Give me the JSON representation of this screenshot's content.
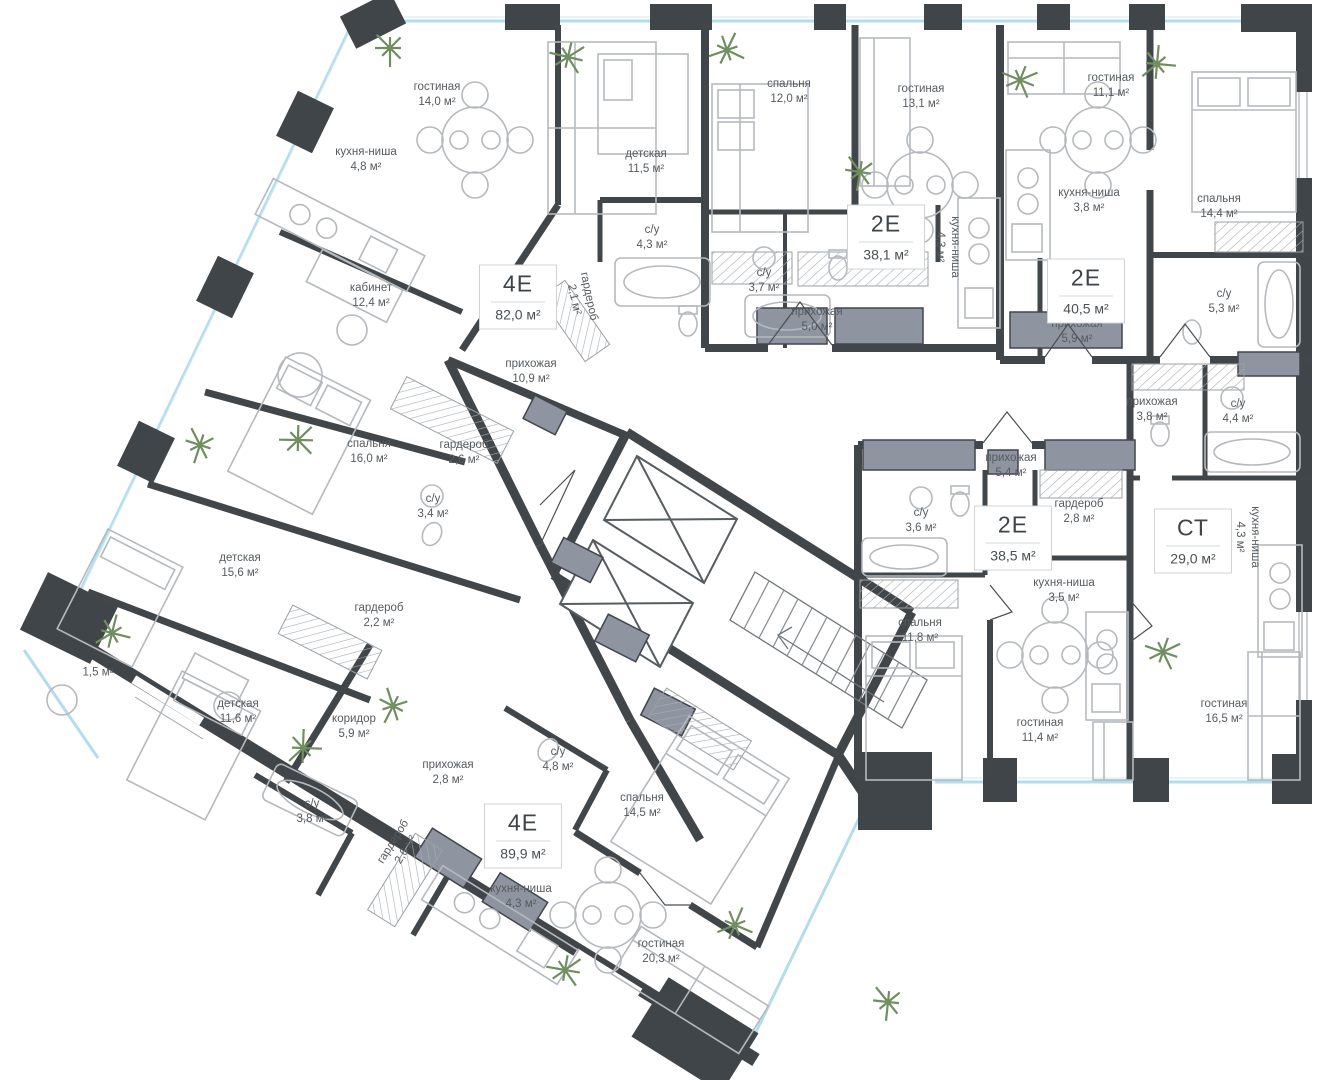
{
  "plan": {
    "title": "floor-plan",
    "unit_suffix": "м²",
    "colors": {
      "wall": "#3f4549",
      "glazing": "#b3dcec",
      "shaft": "#8e95a1",
      "furniture": "#b5b9be",
      "label_text": "#565b5f",
      "plant": "#6f8f5f",
      "badge_border": "#cfd3d6"
    },
    "apartments": [
      {
        "type": "4Е",
        "area": "82,0 м²",
        "x": 518,
        "y": 297
      },
      {
        "type": "2Е",
        "area": "38,1 м²",
        "x": 886,
        "y": 237
      },
      {
        "type": "2Е",
        "area": "40,5 м²",
        "x": 1086,
        "y": 291
      },
      {
        "type": "2Е",
        "area": "38,5 м²",
        "x": 1013,
        "y": 538
      },
      {
        "type": "СТ",
        "area": "29,0 м²",
        "x": 1193,
        "y": 541
      },
      {
        "type": "4Е",
        "area": "89,9 м²",
        "x": 523,
        "y": 836
      }
    ],
    "rooms": [
      {
        "n": "гостиная",
        "a": "14,0 м²",
        "x": 437,
        "y": 95,
        "r": 0
      },
      {
        "n": "кухня-ниша",
        "a": "4,8 м²",
        "x": 366,
        "y": 160,
        "r": 0
      },
      {
        "n": "кабинет",
        "a": "12,4 м²",
        "x": 371,
        "y": 296,
        "r": 0
      },
      {
        "n": "детская",
        "a": "11,5 м²",
        "x": 646,
        "y": 162,
        "r": 0
      },
      {
        "n": "с/у",
        "a": "4,3 м²",
        "x": 652,
        "y": 238,
        "r": 0
      },
      {
        "n": "гардероб",
        "a": "2,1 м²",
        "x": 581,
        "y": 298,
        "r": 78
      },
      {
        "n": "прихожая",
        "a": "10,9 м²",
        "x": 531,
        "y": 372,
        "r": 0
      },
      {
        "n": "спальня",
        "a": "16,0 м²",
        "x": 369,
        "y": 452,
        "r": 0
      },
      {
        "n": "гардероб",
        "a": "2,6 м²",
        "x": 464,
        "y": 453,
        "r": 0
      },
      {
        "n": "с/у",
        "a": "3,4 м²",
        "x": 433,
        "y": 507,
        "r": 0
      },
      {
        "n": "детская",
        "a": "15,6 м²",
        "x": 240,
        "y": 566,
        "r": 0
      },
      {
        "n": "спальня",
        "a": "12,0 м²",
        "x": 789,
        "y": 92,
        "r": 0
      },
      {
        "n": "с/у",
        "a": "3,7 м²",
        "x": 764,
        "y": 281,
        "r": 0
      },
      {
        "n": "прихожая",
        "a": "5,0 м²",
        "x": 817,
        "y": 320,
        "r": 0
      },
      {
        "n": "гостиная",
        "a": "13,1 м²",
        "x": 921,
        "y": 97,
        "r": 0
      },
      {
        "n": "кухня-ниша",
        "a": "4,3 м²",
        "x": 947,
        "y": 247,
        "r": 90
      },
      {
        "n": "гостиная",
        "a": "11,1 м²",
        "x": 1111,
        "y": 86,
        "r": 0
      },
      {
        "n": "кухня-ниша",
        "a": "3,8 м²",
        "x": 1089,
        "y": 201,
        "r": 0
      },
      {
        "n": "прихожая",
        "a": "5,9 м²",
        "x": 1077,
        "y": 332,
        "r": 0
      },
      {
        "n": "спальня",
        "a": "14,4 м²",
        "x": 1219,
        "y": 207,
        "r": 0
      },
      {
        "n": "с/у",
        "a": "5,3 м²",
        "x": 1224,
        "y": 302,
        "r": 0
      },
      {
        "n": "прихожая",
        "a": "3,8 м²",
        "x": 1152,
        "y": 410,
        "r": 0
      },
      {
        "n": "с/у",
        "a": "4,4 м²",
        "x": 1238,
        "y": 412,
        "r": 0
      },
      {
        "n": "кухня-ниша",
        "a": "4,3 м²",
        "x": 1247,
        "y": 537,
        "r": 90
      },
      {
        "n": "гостиная",
        "a": "16,5 м²",
        "x": 1224,
        "y": 712,
        "r": 0
      },
      {
        "n": "прихожая",
        "a": "5,4 м²",
        "x": 1011,
        "y": 466,
        "r": 0
      },
      {
        "n": "с/у",
        "a": "3,6 м²",
        "x": 921,
        "y": 521,
        "r": 0
      },
      {
        "n": "гардероб",
        "a": "2,8 м²",
        "x": 1079,
        "y": 512,
        "r": 0
      },
      {
        "n": "кухня-ниша",
        "a": "3,5 м²",
        "x": 1064,
        "y": 591,
        "r": 0
      },
      {
        "n": "спальня",
        "a": "11,8 м²",
        "x": 920,
        "y": 631,
        "r": 0
      },
      {
        "n": "гостиная",
        "a": "11,4 м²",
        "x": 1040,
        "y": 731,
        "r": 0
      },
      {
        "n": "гардероб",
        "a": "2,2 м²",
        "x": 379,
        "y": 616,
        "r": 0
      },
      {
        "n": "",
        "a": "1,5 м²",
        "x": 98,
        "y": 673,
        "r": 0
      },
      {
        "n": "детская",
        "a": "11,6 м²",
        "x": 238,
        "y": 712,
        "r": 0
      },
      {
        "n": "коридор",
        "a": "5,9 м²",
        "x": 354,
        "y": 727,
        "r": 0
      },
      {
        "n": "прихожая",
        "a": "2,8 м²",
        "x": 448,
        "y": 773,
        "r": 0
      },
      {
        "n": "с/у",
        "a": "3,8 м²",
        "x": 312,
        "y": 812,
        "r": 0
      },
      {
        "n": "гардероб",
        "a": "2,6 м²",
        "x": 400,
        "y": 846,
        "r": -58
      },
      {
        "n": "с/у",
        "a": "4,8 м²",
        "x": 558,
        "y": 760,
        "r": 0
      },
      {
        "n": "спальня",
        "a": "14,5 м²",
        "x": 642,
        "y": 806,
        "r": 0
      },
      {
        "n": "кухня-ниша",
        "a": "4,3 м²",
        "x": 521,
        "y": 897,
        "r": 0
      },
      {
        "n": "гостиная",
        "a": "20,3 м²",
        "x": 661,
        "y": 952,
        "r": 0
      }
    ],
    "plants": [
      [
        390,
        48
      ],
      [
        568,
        57
      ],
      [
        727,
        50
      ],
      [
        860,
        172
      ],
      [
        1020,
        80
      ],
      [
        1157,
        64
      ],
      [
        200,
        445
      ],
      [
        298,
        440
      ],
      [
        112,
        633
      ],
      [
        393,
        706
      ],
      [
        565,
        970
      ],
      [
        735,
        925
      ],
      [
        888,
        1002
      ],
      [
        1163,
        652
      ],
      [
        303,
        748
      ]
    ]
  }
}
